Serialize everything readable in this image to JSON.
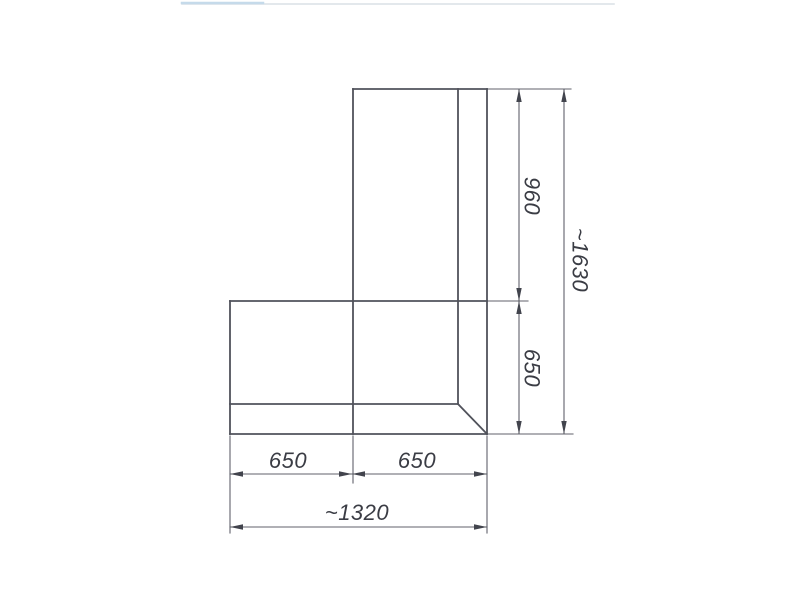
{
  "document": {
    "type": "technical-drawing",
    "title": "L-shaped corner unit, top view with dimensions"
  },
  "canvas": {
    "width": 800,
    "height": 600,
    "background": "#ffffff"
  },
  "style": {
    "shape_stroke": "#50525b",
    "shape_stroke_width": 1.8,
    "dim_stroke": "#60626b",
    "dim_stroke_width": 1.1,
    "arrow_fill": "#42444d",
    "text_color": "#3a3c44",
    "font_size": 22,
    "arrow_length": 13,
    "arrow_half_width": 2.7
  },
  "dimensions": [
    {
      "id": "960",
      "label": "960",
      "orientation": "vertical",
      "x": 532,
      "y": 196,
      "rotate": 90
    },
    {
      "id": "650-right",
      "label": "650",
      "orientation": "vertical",
      "x": 532,
      "y": 368,
      "rotate": 90
    },
    {
      "id": "1630",
      "label": "~1630",
      "orientation": "vertical",
      "x": 580,
      "y": 260,
      "rotate": 90
    },
    {
      "id": "650-bottom-left",
      "label": "650",
      "orientation": "horizontal",
      "x": 288,
      "y": 468,
      "rotate": 0
    },
    {
      "id": "650-bottom-right",
      "label": "650",
      "orientation": "horizontal",
      "x": 417,
      "y": 468,
      "rotate": 0
    },
    {
      "id": "1320",
      "label": "~1320",
      "orientation": "horizontal",
      "x": 357,
      "y": 520,
      "rotate": 0
    }
  ],
  "geometry": {
    "shape_segments": [
      {
        "name": "top-edge",
        "x1": 353,
        "y1": 89,
        "x2": 487,
        "y2": 89
      },
      {
        "name": "right-edge",
        "x1": 487,
        "y1": 89,
        "x2": 487,
        "y2": 434
      },
      {
        "name": "bottom-edge",
        "x1": 230,
        "y1": 434,
        "x2": 487,
        "y2": 434
      },
      {
        "name": "left-edge",
        "x1": 230,
        "y1": 301,
        "x2": 230,
        "y2": 434
      },
      {
        "name": "module-divider-top",
        "x1": 230,
        "y1": 301,
        "x2": 487,
        "y2": 301
      },
      {
        "name": "module-divider-vertical",
        "x1": 353,
        "y1": 89,
        "x2": 353,
        "y2": 434
      },
      {
        "name": "inner-back-vertical",
        "x1": 458,
        "y1": 89,
        "x2": 458,
        "y2": 404
      },
      {
        "name": "inner-back-horizontal",
        "x1": 230,
        "y1": 404,
        "x2": 458,
        "y2": 404
      },
      {
        "name": "corner-diagonal",
        "x1": 458,
        "y1": 404,
        "x2": 487,
        "y2": 434
      }
    ],
    "thin_segments": [
      {
        "name": "extension-top-right",
        "x1": 487,
        "y1": 89,
        "x2": 571,
        "y2": 89
      },
      {
        "name": "extension-middle-right",
        "x1": 487,
        "y1": 301,
        "x2": 528,
        "y2": 301
      },
      {
        "name": "extension-bottom-right",
        "x1": 487,
        "y1": 434,
        "x2": 573,
        "y2": 434
      },
      {
        "name": "extension-below-left",
        "x1": 230,
        "y1": 436,
        "x2": 230,
        "y2": 533
      },
      {
        "name": "extension-below-middle",
        "x1": 353,
        "y1": 436,
        "x2": 353,
        "y2": 483
      },
      {
        "name": "extension-below-right",
        "x1": 487,
        "y1": 436,
        "x2": 487,
        "y2": 533
      },
      {
        "name": "dim-line-right-inner",
        "x1": 519,
        "y1": 89,
        "x2": 519,
        "y2": 434
      },
      {
        "name": "dim-line-right-outer",
        "x1": 564,
        "y1": 89,
        "x2": 564,
        "y2": 434
      },
      {
        "name": "dim-line-bottom-inner",
        "x1": 230,
        "y1": 474,
        "x2": 487,
        "y2": 474
      },
      {
        "name": "dim-line-bottom-outer",
        "x1": 230,
        "y1": 527,
        "x2": 487,
        "y2": 527
      }
    ],
    "arrows": [
      {
        "x": 519,
        "y": 89,
        "dir": "up"
      },
      {
        "x": 519,
        "y": 301,
        "dir": "down"
      },
      {
        "x": 519,
        "y": 301,
        "dir": "up"
      },
      {
        "x": 519,
        "y": 434,
        "dir": "down"
      },
      {
        "x": 564,
        "y": 89,
        "dir": "up"
      },
      {
        "x": 564,
        "y": 434,
        "dir": "down"
      },
      {
        "x": 230,
        "y": 474,
        "dir": "left"
      },
      {
        "x": 352,
        "y": 474,
        "dir": "right"
      },
      {
        "x": 352,
        "y": 474,
        "dir": "left"
      },
      {
        "x": 487,
        "y": 474,
        "dir": "right"
      },
      {
        "x": 230,
        "y": 527,
        "dir": "left"
      },
      {
        "x": 487,
        "y": 527,
        "dir": "right"
      }
    ],
    "artifacts": [
      {
        "name": "scan-edge-line-gray",
        "x1": 182,
        "y1": 4,
        "x2": 614,
        "y2": 4,
        "color": "#dae1e6",
        "width": 1.6
      },
      {
        "name": "scan-edge-line-blue",
        "x1": 182,
        "y1": 3,
        "x2": 263,
        "y2": 3,
        "color": "#c5daea",
        "width": 2.5
      }
    ]
  }
}
